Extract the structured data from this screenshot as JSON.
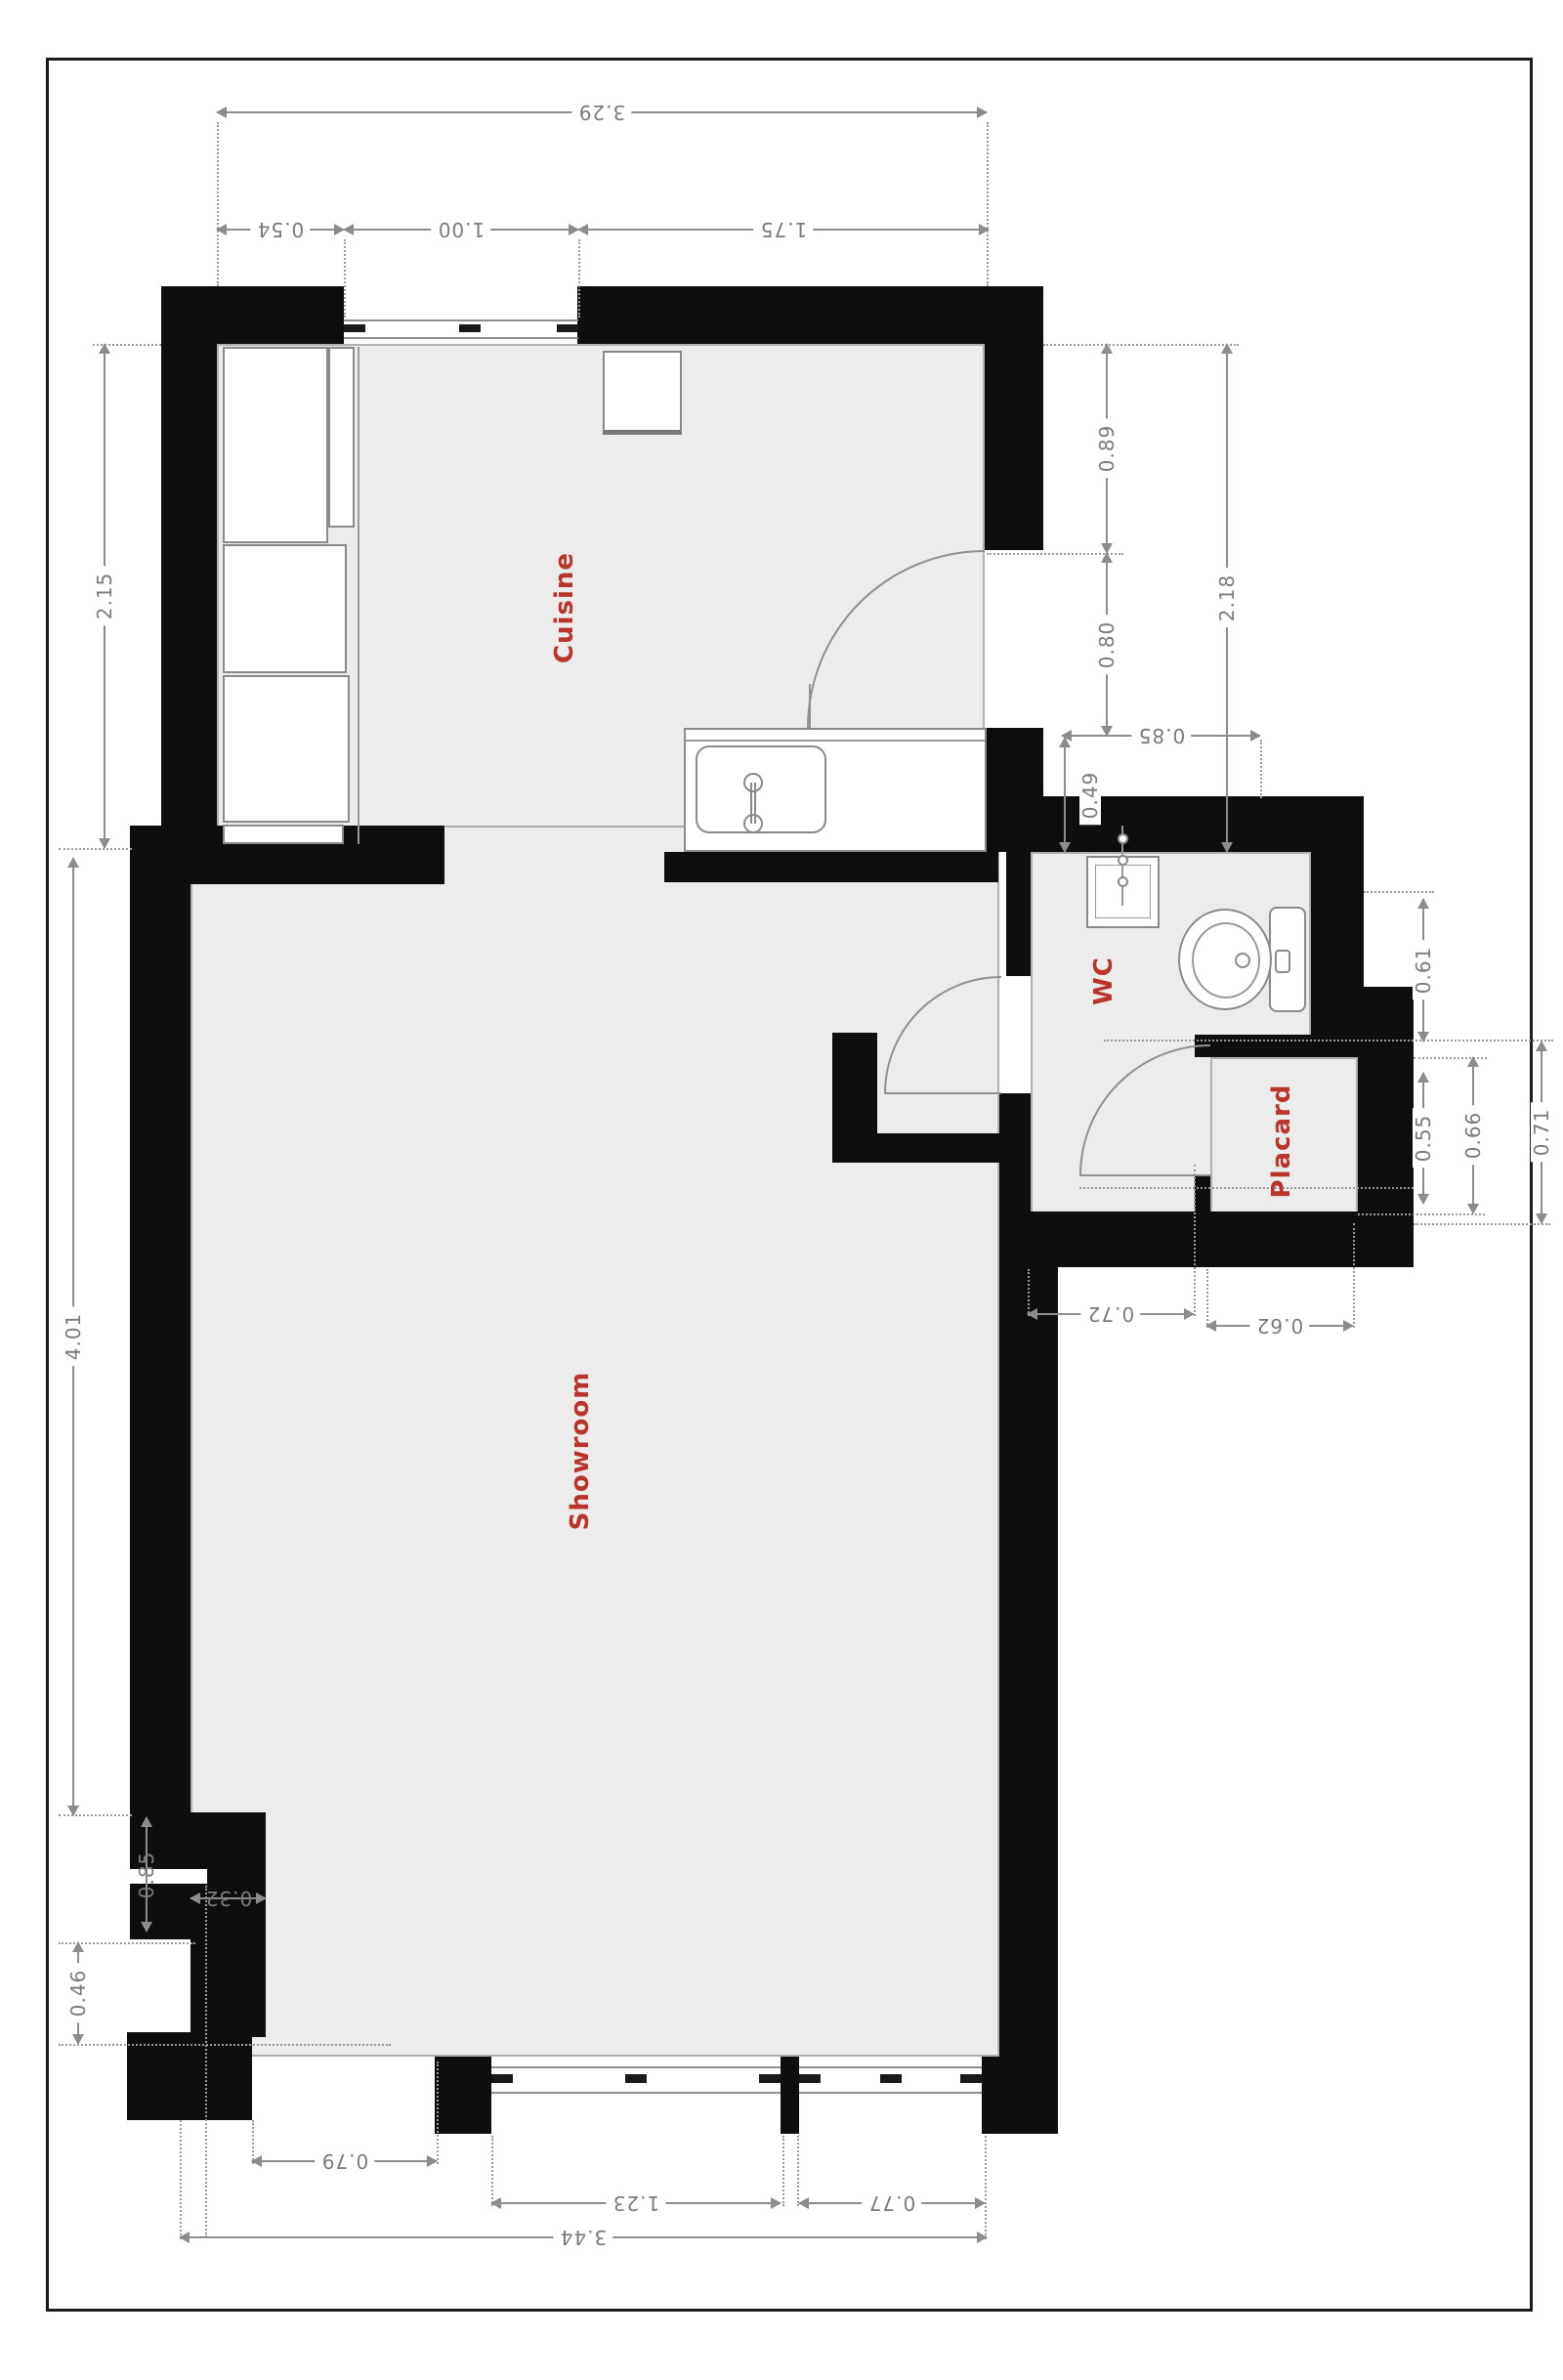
{
  "plan_title": "Floor plan",
  "rooms": {
    "cuisine": "Cuisine",
    "showroom": "Showroom",
    "wc": "WC",
    "placard": "Placard"
  },
  "dimensions": {
    "top_total": "3.29",
    "top_left": "0.54",
    "top_window": "1.00",
    "top_right": "1.75",
    "kitchen_height": "2.15",
    "kitchen_door_top": "0.89",
    "kitchen_door": "0.80",
    "kitchen_right_total": "2.18",
    "kitchen_niche": "0.85",
    "kitchen_niche_depth": "0.49",
    "wc_east": "0.61",
    "placard_inner": "0.55",
    "placard_mid": "0.66",
    "placard_outer": "0.71",
    "wc_south": "0.72",
    "placard_south": "0.62",
    "showroom_height": "4.01",
    "west_pilaster": "0.85",
    "west_notch": "0.32",
    "west_lower": "0.46",
    "bottom_door": "0.79",
    "bottom_window1": "1.23",
    "bottom_window2": "0.77",
    "bottom_total": "3.44"
  },
  "colors": {
    "wall": "#0e0e0e",
    "floor": "#ececec",
    "dimension": "#8c8c8c",
    "room_label": "#b9342c",
    "fixture_border": "#8a8a8a"
  }
}
